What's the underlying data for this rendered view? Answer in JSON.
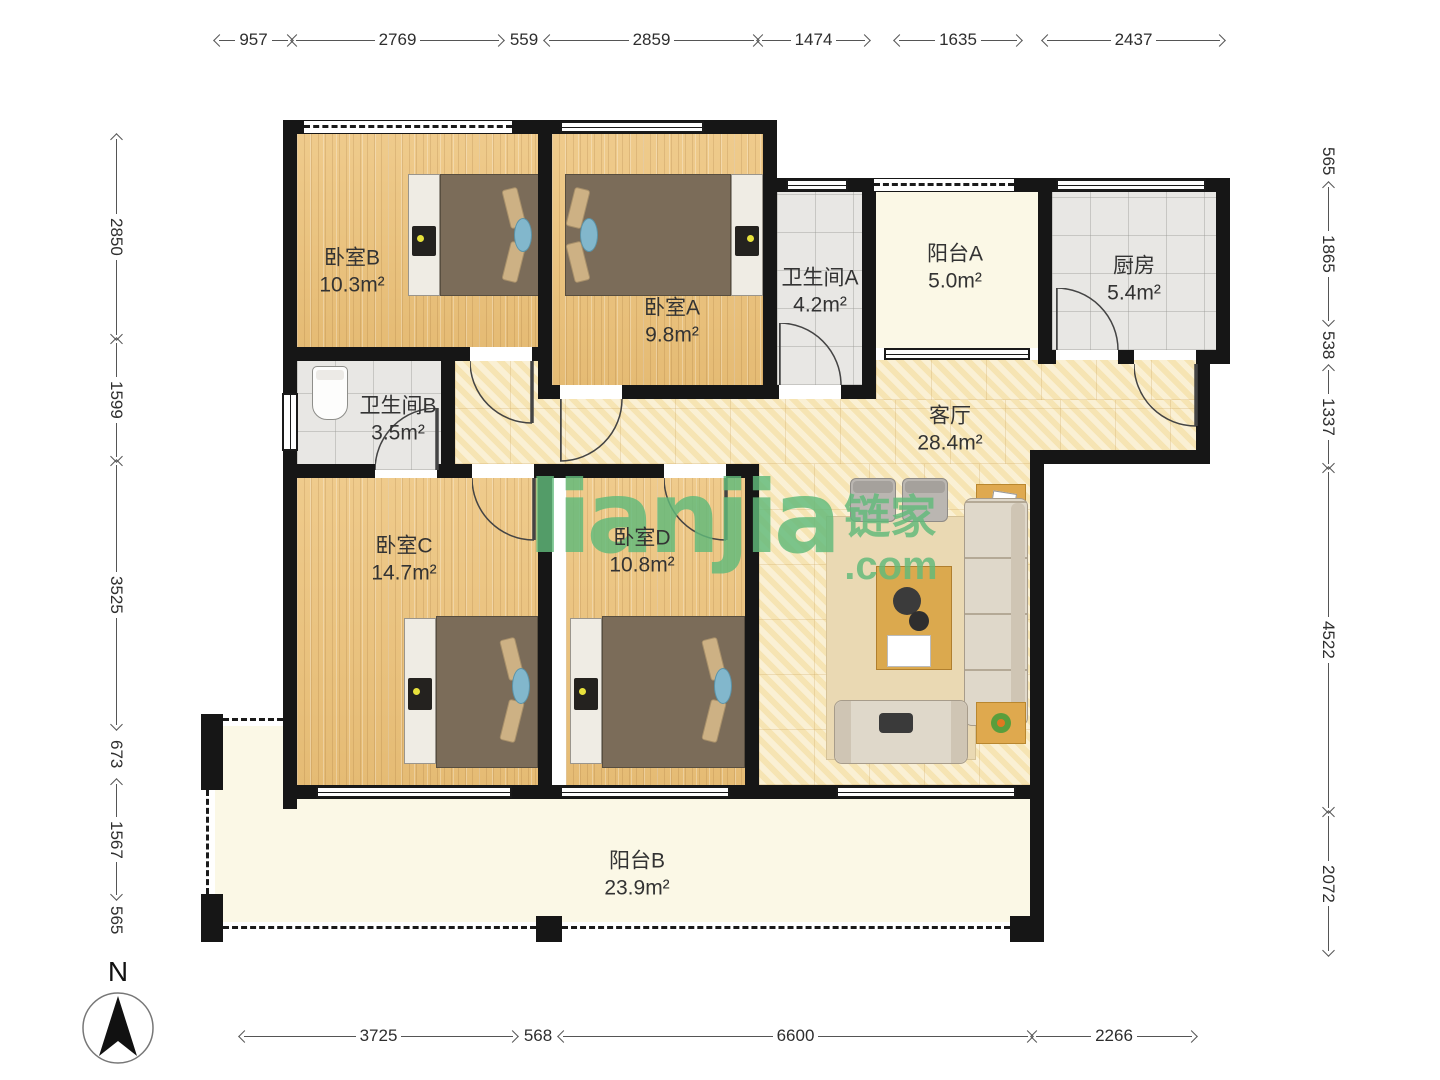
{
  "plan_title": "4室2卫户型图",
  "compass": {
    "label": "N"
  },
  "watermark": {
    "main": "lianjia",
    "cjk": "链家",
    "dotcom": ".com"
  },
  "rooms": [
    {
      "id": "bedroomB",
      "name": "卧室B",
      "area": "10.3m²"
    },
    {
      "id": "bedroomA",
      "name": "卧室A",
      "area": "9.8m²"
    },
    {
      "id": "bathA",
      "name": "卫生间A",
      "area": "4.2m²"
    },
    {
      "id": "balconyA",
      "name": "阳台A",
      "area": "5.0m²"
    },
    {
      "id": "kitchen",
      "name": "厨房",
      "area": "5.4m²"
    },
    {
      "id": "bathB",
      "name": "卫生间B",
      "area": "3.5m²"
    },
    {
      "id": "living",
      "name": "客厅",
      "area": "28.4m²"
    },
    {
      "id": "bedroomC",
      "name": "卧室C",
      "area": "14.7m²"
    },
    {
      "id": "bedroomD",
      "name": "卧室D",
      "area": "10.8m²"
    },
    {
      "id": "balconyB",
      "name": "阳台B",
      "area": "23.9m²"
    }
  ],
  "dimensions": {
    "top": [
      "957",
      "2769",
      "559",
      "2859",
      "1474",
      "1635",
      "2437"
    ],
    "left": [
      "2850",
      "1599",
      "3525",
      "673",
      "1567",
      "565"
    ],
    "right": [
      "565",
      "1865",
      "538",
      "1337",
      "4522",
      "2072"
    ],
    "bottom": [
      "3725",
      "568",
      "6600",
      "2266"
    ]
  },
  "colors": {
    "wall": "#161616",
    "wood_floor": "#ECC581",
    "marble_floor": "#F7E8BD",
    "tile_floor": "#E8E7E4",
    "balcony_floor": "#FBF8E6",
    "watermark_green": "#62BE7E"
  }
}
